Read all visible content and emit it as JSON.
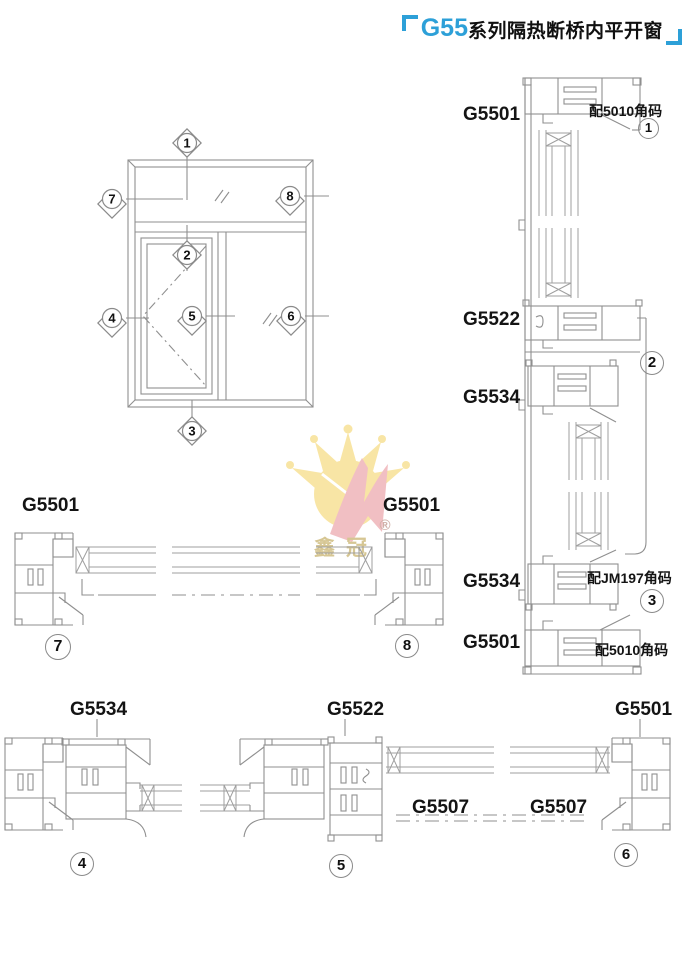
{
  "colors": {
    "accent_blue": "#2da0d8",
    "line_gray": "#8f8f8f",
    "text_black": "#141414",
    "watermark_yellow": "#f8e39c",
    "watermark_pink": "#f0b9bd",
    "watermark_text": "#d6c693"
  },
  "header": {
    "title_model": "G55",
    "title_text": "系列隔热断桥内平开窗"
  },
  "elevation": {
    "markers": {
      "m1": "1",
      "m2": "2",
      "m3": "3",
      "m4": "4",
      "m5": "5",
      "m6": "6",
      "m7": "7",
      "m8": "8"
    }
  },
  "vertical_section": {
    "label_top_frame": "G5501",
    "label_transom": "G5522",
    "label_upper_sash": "G5534",
    "label_lower_sash": "G5534",
    "label_bottom_frame": "G5501",
    "note_top": "配5010角码",
    "note_mid": "配JM197角码",
    "note_bottom": "配5010角码",
    "callout_top": "1",
    "callout_mid": "2",
    "callout_bottom": "3"
  },
  "mid_section": {
    "label_left": "G5501",
    "label_right": "G5501",
    "callout_left": "7",
    "callout_right": "8"
  },
  "bottom_section": {
    "label_left": "G5534",
    "label_mid": "G5522",
    "label_right": "G5501",
    "glass_label_left": "G5507",
    "glass_label_right": "G5507",
    "callout_left": "4",
    "callout_mid": "5",
    "callout_right": "6"
  },
  "watermark": {
    "brand": "鑫冠",
    "registered": "®"
  }
}
